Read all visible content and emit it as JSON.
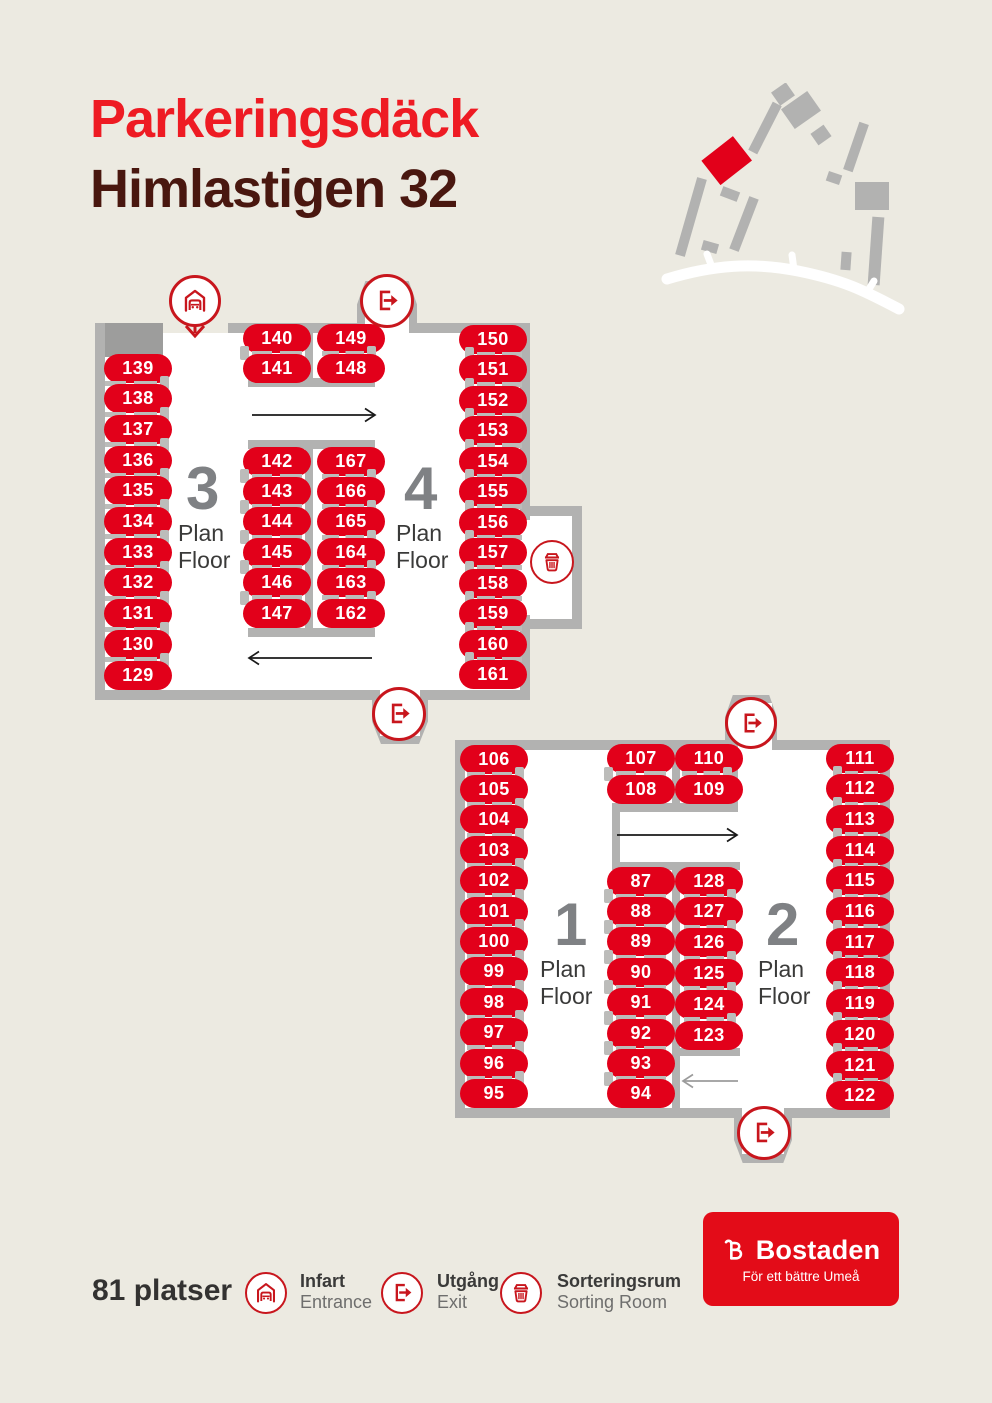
{
  "title": {
    "line1": "Parkeringsdäck",
    "line2": "Himlastigen 32"
  },
  "colors": {
    "background": "#ECEAE1",
    "wall": "#B2B2B1",
    "wall_dark": "#9D9D9C",
    "spot_red": "#E2001A",
    "icon_red": "#C8161D",
    "title_red": "#EE1B23",
    "title_maroon": "#49170F",
    "floor_number_gray": "#7F8184",
    "text_dark": "#3A3A39",
    "text_gray": "#6E6E6D",
    "logo_red": "#E30C18"
  },
  "site_map": {
    "highlighted_building_color": "#E2001A",
    "building_color": "#B2B2B1",
    "road_color": "#FFFFFF"
  },
  "plans": [
    {
      "name": "upper-deck-floors-3-4",
      "floors": [
        {
          "number": "3",
          "line1": "Plan",
          "line2": "Floor"
        },
        {
          "number": "4",
          "line1": "Plan",
          "line2": "Floor"
        }
      ],
      "columns": {
        "left": [
          139,
          138,
          137,
          136,
          135,
          134,
          133,
          132,
          131,
          130,
          129
        ],
        "top_left": [
          140,
          141
        ],
        "top_right": [
          149,
          148
        ],
        "mid_left": [
          142,
          143,
          144,
          145,
          146,
          147
        ],
        "mid_right": [
          167,
          166,
          165,
          164,
          163,
          162
        ],
        "right": [
          150,
          151,
          152,
          153,
          154,
          155,
          156,
          157,
          158,
          159,
          160,
          161
        ]
      }
    },
    {
      "name": "lower-deck-floors-1-2",
      "floors": [
        {
          "number": "1",
          "line1": "Plan",
          "line2": "Floor"
        },
        {
          "number": "2",
          "line1": "Plan",
          "line2": "Floor"
        }
      ],
      "columns": {
        "left": [
          106,
          105,
          104,
          103,
          102,
          101,
          100,
          99,
          98,
          97,
          96,
          95
        ],
        "top_left": [
          107,
          108
        ],
        "top_right": [
          110,
          109
        ],
        "mid_left": [
          87,
          88,
          89,
          90,
          91,
          92,
          93,
          94
        ],
        "mid_right": [
          128,
          127,
          126,
          125,
          124,
          123
        ],
        "right": [
          111,
          112,
          113,
          114,
          115,
          116,
          117,
          118,
          119,
          120,
          121,
          122
        ]
      }
    }
  ],
  "legend": {
    "total": "81 platser",
    "items": [
      {
        "icon": "entrance-icon",
        "sv": "Infart",
        "en": "Entrance"
      },
      {
        "icon": "exit-icon",
        "sv": "Utgång",
        "en": "Exit"
      },
      {
        "icon": "sorting-icon",
        "sv": "Sorteringsrum",
        "en": "Sorting Room"
      }
    ]
  },
  "logo": {
    "brand": "Bostaden",
    "tagline": "För ett bättre Umeå"
  }
}
